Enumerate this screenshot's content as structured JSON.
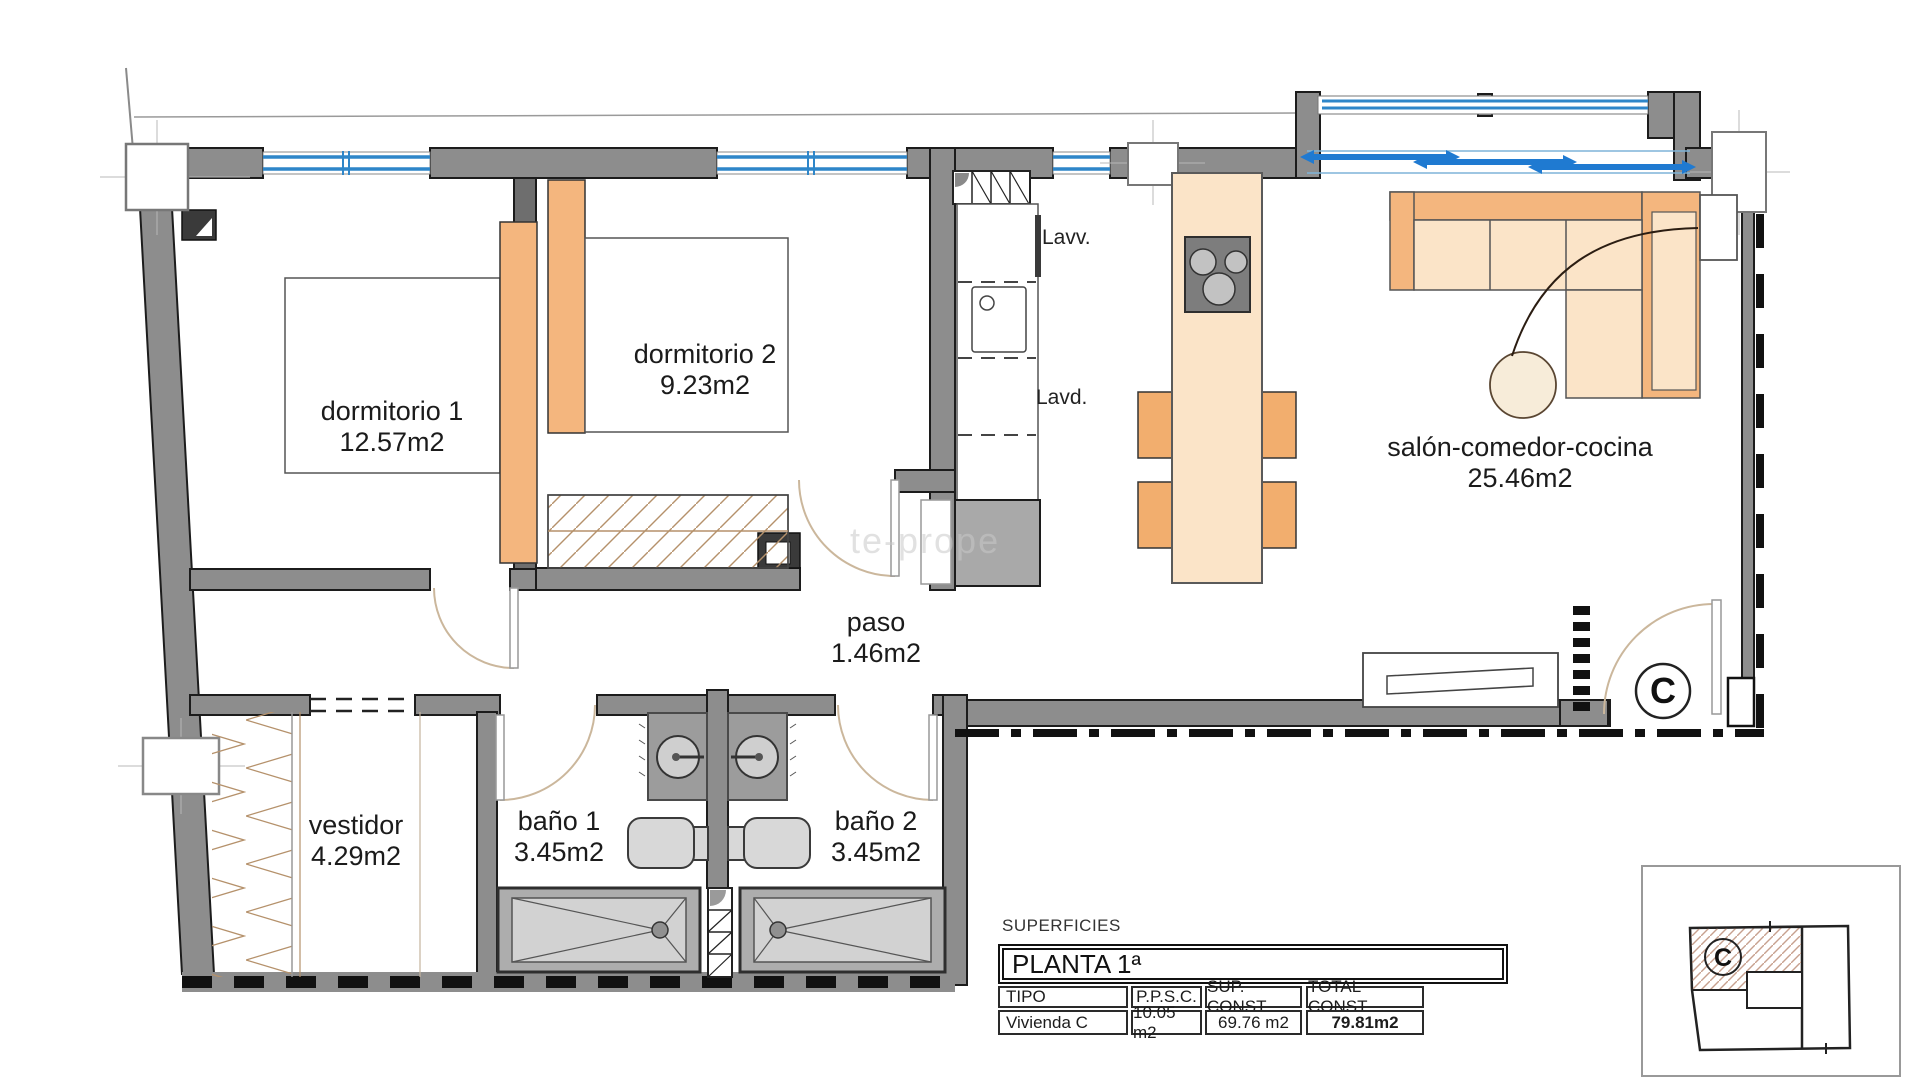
{
  "rooms": [
    {
      "name": "dormitorio 1",
      "area": "12.57m2"
    },
    {
      "name": "dormitorio 2",
      "area": "9.23m2"
    },
    {
      "name": "salón-comedor-cocina",
      "area": "25.46m2"
    },
    {
      "name": "paso",
      "area": "1.46m2"
    },
    {
      "name": "vestidor",
      "area": "4.29m2"
    },
    {
      "name": "baño 1",
      "area": "3.45m2"
    },
    {
      "name": "baño 2",
      "area": "3.45m2"
    }
  ],
  "appliances": {
    "dishwasher": "Lavv.",
    "washer": "Lavd."
  },
  "entry": {
    "label": "C"
  },
  "keyplan": {
    "unit_label": "C"
  },
  "watermark": "te-prope",
  "surfaces_table": {
    "title": "SUPERFICIES",
    "floor": "PLANTA 1ª",
    "headers": [
      "TIPO",
      "P.P.S.C.",
      "SUP. CONST.",
      "TOTAL CONST."
    ],
    "row": [
      "Vivienda C",
      "10.05 m2",
      "69.76 m2",
      "79.81m2"
    ]
  },
  "colors": {
    "wall": "#8d8d8d",
    "window_blue": "#2e86c9",
    "slider_blue": "#1f7ad1",
    "furniture_light": "#fbe4c8",
    "furniture_orange": "#f4b67e",
    "hatch_tan": "#c7a18f",
    "fixture_gray": "#9c9c9c"
  }
}
